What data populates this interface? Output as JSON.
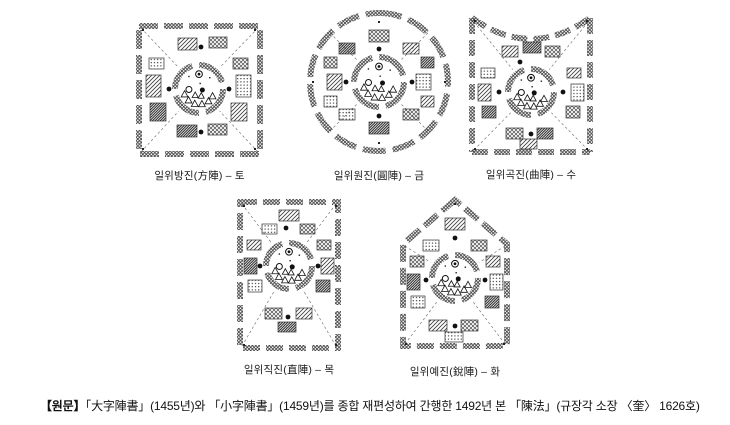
{
  "page": {
    "background": "#ffffff",
    "ink": "#1a1a1a"
  },
  "figures": [
    {
      "shape": "square",
      "label": "일위방진(方陣) – 토"
    },
    {
      "shape": "circle",
      "label": "일위원진(圓陣) – 금"
    },
    {
      "shape": "curved",
      "label": "일위곡진(曲陣) – 수"
    },
    {
      "shape": "straight",
      "label": "일위직진(直陣) – 목"
    },
    {
      "shape": "pointed",
      "label": "일위예진(銳陣) – 화"
    }
  ],
  "caption": {
    "prefix": "【원문】",
    "text": "「大字陣書」(1455년)와 「小字陣書」(1459년)를 종합 재편성하여 간행한 1492년 본 「陳法」(규장각 소장 〈奎〉 1626호)"
  }
}
